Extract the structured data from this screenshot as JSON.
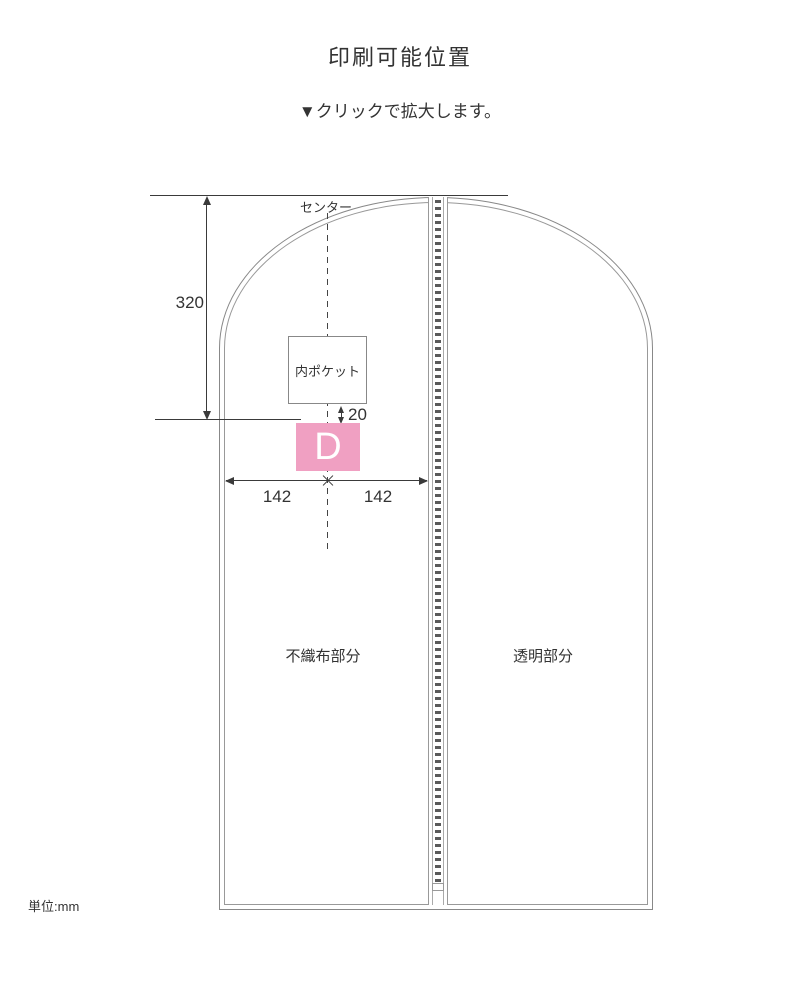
{
  "page": {
    "title": "印刷可能位置",
    "subtitle": "▼クリックで拡大します。",
    "unit_note": "単位:mm"
  },
  "diagram": {
    "center_label": "センター",
    "pocket_label": "内ポケット",
    "print_area_label": "D",
    "left_area_label": "不織布部分",
    "right_area_label": "透明部分",
    "dimensions": {
      "top_to_print_area": "320",
      "pocket_to_print_gap": "20",
      "center_left_half": "142",
      "center_right_half": "142"
    },
    "colors": {
      "print_area_pink": "#f0a0c2",
      "outline_gray": "#888888",
      "dimension_dark": "#3a3a3a"
    }
  }
}
